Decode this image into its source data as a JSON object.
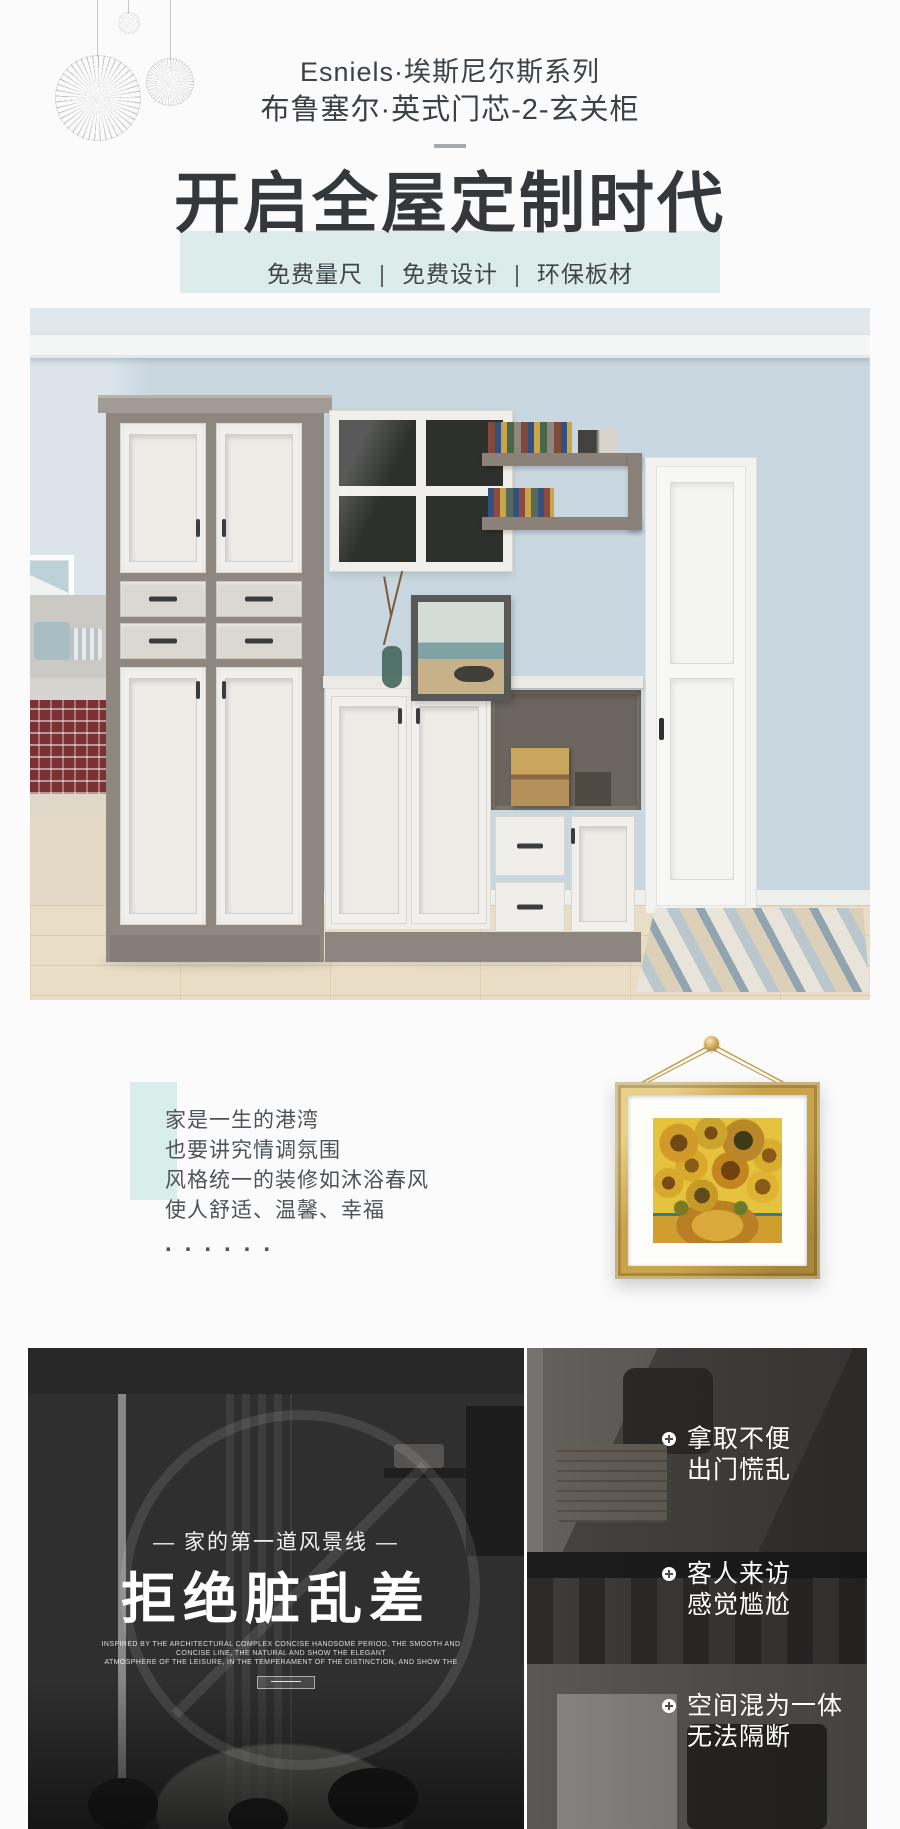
{
  "header": {
    "series_title": "Esniels·埃斯尼尔斯系列",
    "product_title": "布鲁塞尔·英式门芯-2-玄关柜",
    "headline": "开启全屋定制时代",
    "benefit_1": "免费量尺",
    "benefit_2": "免费设计",
    "benefit_3": "环保板材",
    "separator": "|"
  },
  "intro": {
    "line1": "家是一生的港湾",
    "line2": "也要讲究情调氛围",
    "line3": "风格统一的装修如沐浴春风",
    "line4": "使人舒适、温馨、幸福",
    "dots": "......"
  },
  "pain": {
    "tagline": "— 家的第一道风景线 —",
    "title": "拒绝脏乱差",
    "sub_en_1": "INSPIRED BY THE ARCHITECTURAL COMPLEX CONCISE HANDSOME PERIOD, THE SMOOTH AND CONCISE LINE, THE NATURAL AND SHOW THE ELEGANT",
    "sub_en_2": "ATMOSPHERE OF THE LEISURE, IN THE TEMPERAMENT OF THE DISTINCTION, AND SHOW THE",
    "bullets": [
      {
        "line1": "拿取不便",
        "line2": "出门慌乱"
      },
      {
        "line1": "客人来访",
        "line2": "感觉尴尬"
      },
      {
        "line1": "空间混为一体",
        "line2": "无法隔断"
      }
    ]
  },
  "icons": {
    "bullet_icon": "plus-circle",
    "ornament_icon": "dandelion-ball"
  },
  "colors": {
    "accent_teal_band": "#dceceb",
    "accent_teal_rect": "#d9edeb",
    "heading_dark": "#34383b",
    "body_text": "#4e5357",
    "frame_gold": "#c9a44c",
    "dark_section_text": "#ffffff"
  }
}
